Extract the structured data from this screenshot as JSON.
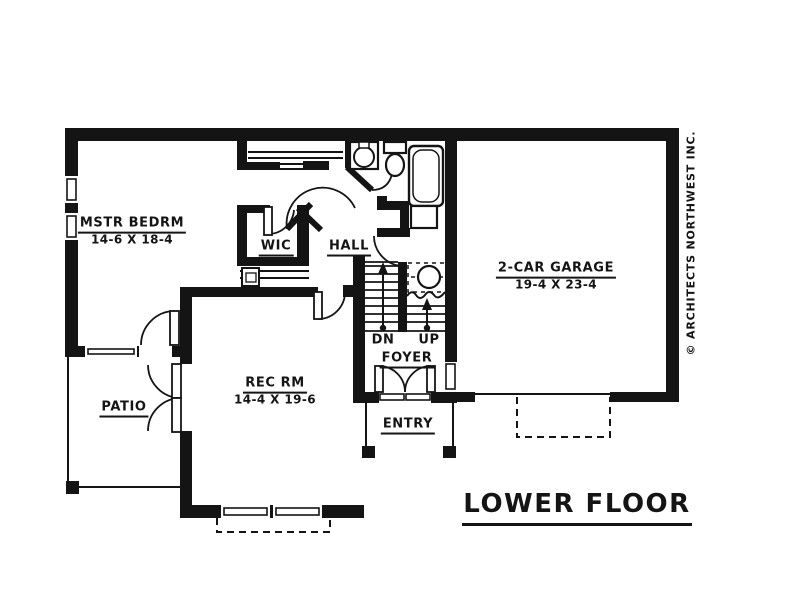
{
  "page": {
    "background": "#ffffff",
    "ink": "#141414"
  },
  "title": {
    "label": "LOWER FLOOR"
  },
  "copyright_label": "© ARCHITECTS NORTHWEST INC.",
  "rooms": {
    "master_bedroom": {
      "name": "MSTR BEDRM",
      "dims": "14-6 X 18-4"
    },
    "wic": {
      "name": "WIC"
    },
    "hall": {
      "name": "HALL"
    },
    "garage": {
      "name": "2-CAR GARAGE",
      "dims": "19-4 X 23-4"
    },
    "rec_room": {
      "name": "REC RM",
      "dims": "14-4 X 19-6"
    },
    "patio": {
      "name": "PATIO"
    },
    "foyer": {
      "name": "FOYER"
    },
    "entry": {
      "name": "ENTRY"
    }
  },
  "stairs": {
    "down": "DN",
    "up": "UP"
  }
}
